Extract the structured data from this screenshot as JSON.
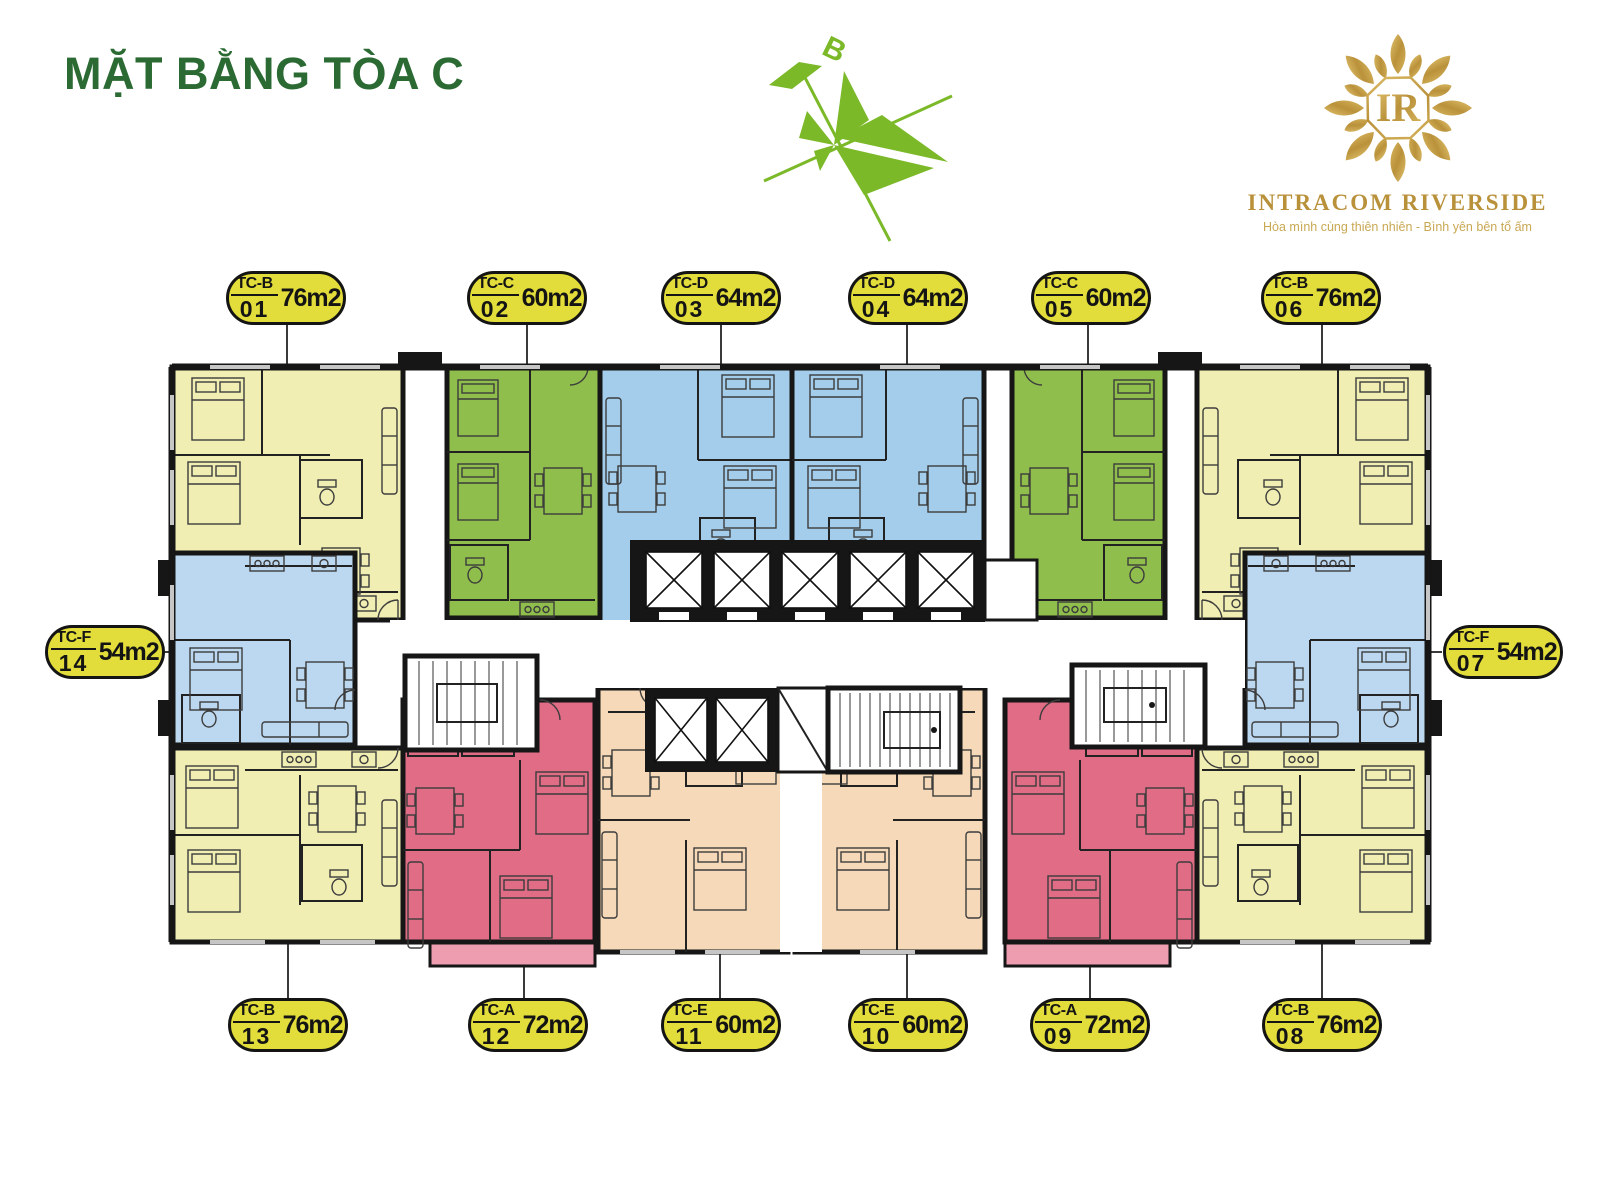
{
  "title": "MẶT BẰNG TÒA C",
  "compass": {
    "label": "B"
  },
  "logo": {
    "monogram": "IR",
    "name": "INTRACOM RIVERSIDE",
    "tagline": "Hòa mình cùng thiên nhiên - Bình yên bên tổ ấm"
  },
  "badges": [
    {
      "id": "01",
      "code": "TC-B",
      "area": "76m2",
      "unit_color": "yellow"
    },
    {
      "id": "02",
      "code": "TC-C",
      "area": "60m2",
      "unit_color": "green"
    },
    {
      "id": "03",
      "code": "TC-D",
      "area": "64m2",
      "unit_color": "blue"
    },
    {
      "id": "04",
      "code": "TC-D",
      "area": "64m2",
      "unit_color": "blue"
    },
    {
      "id": "05",
      "code": "TC-C",
      "area": "60m2",
      "unit_color": "green"
    },
    {
      "id": "06",
      "code": "TC-B",
      "area": "76m2",
      "unit_color": "yellow"
    },
    {
      "id": "07",
      "code": "TC-F",
      "area": "54m2",
      "unit_color": "blue"
    },
    {
      "id": "08",
      "code": "TC-B",
      "area": "76m2",
      "unit_color": "yellow"
    },
    {
      "id": "09",
      "code": "TC-A",
      "area": "72m2",
      "unit_color": "pink"
    },
    {
      "id": "10",
      "code": "TC-E",
      "area": "60m2",
      "unit_color": "peach"
    },
    {
      "id": "11",
      "code": "TC-E",
      "area": "60m2",
      "unit_color": "peach"
    },
    {
      "id": "12",
      "code": "TC-A",
      "area": "72m2",
      "unit_color": "pink"
    },
    {
      "id": "13",
      "code": "TC-B",
      "area": "76m2",
      "unit_color": "yellow"
    },
    {
      "id": "14",
      "code": "TC-F",
      "area": "54m2",
      "unit_color": "blue"
    }
  ],
  "colors": {
    "title": "#2B6B33",
    "compass": "#7BB929",
    "gold": "#B9913A",
    "goldLight": "#C9A853",
    "badge": "#E2DD3A",
    "yellow": "#F0EEB2",
    "green": "#8FBE4D",
    "blue": "#A3CDEB",
    "blueLight": "#BCD8F0",
    "pink": "#E06C86",
    "pinkLight": "#EE9DB0",
    "peach": "#F5D9B8",
    "wall": "#161616"
  }
}
